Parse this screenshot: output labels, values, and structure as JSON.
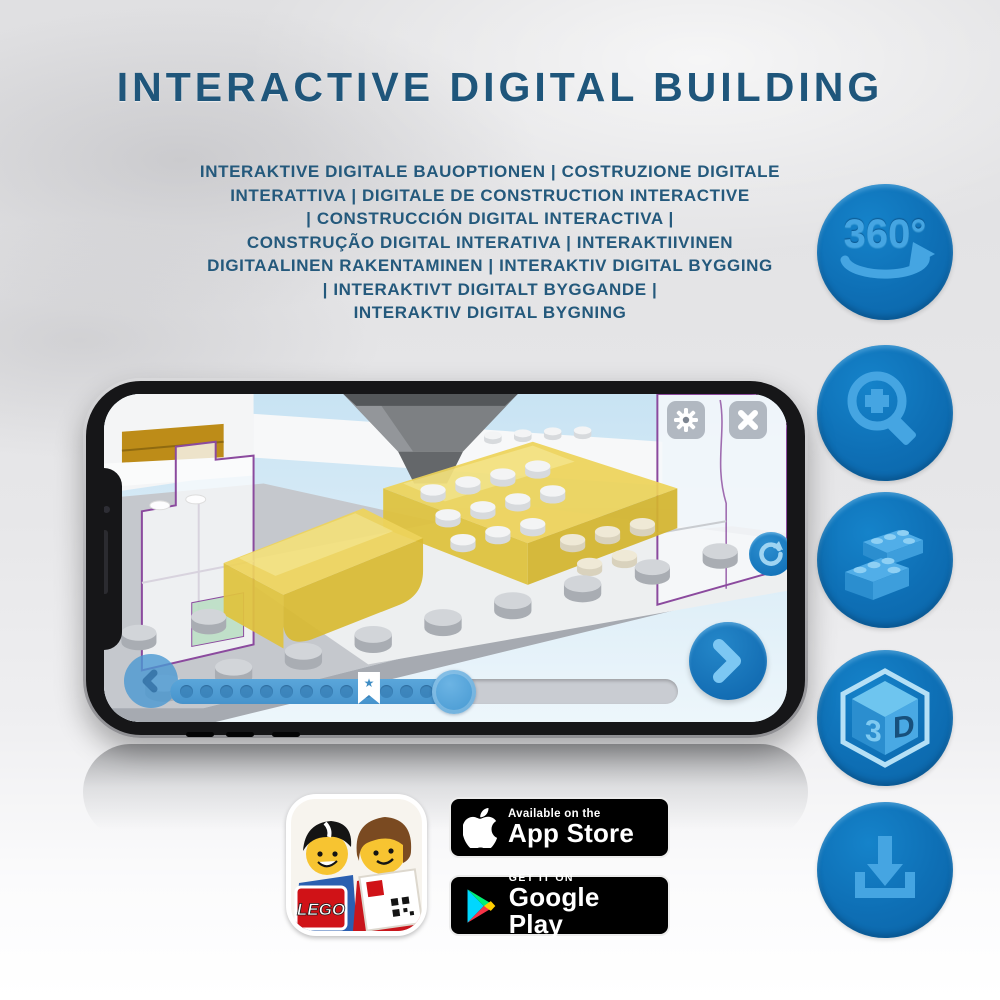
{
  "header": {
    "title": "INTERACTIVE DIGITAL BUILDING",
    "subtitle_lines": [
      "INTERAKTIVE DIGITALE BAUOPTIONEN | COSTRUZIONE DIGITALE",
      "INTERATTIVA | DIGITALE DE CONSTRUCTION INTERACTIVE",
      "| CONSTRUCCIÓN DIGITAL INTERACTIVA |",
      "CONSTRUÇÃO DIGITAL INTERATIVA | INTERAKTIIVINEN",
      "DIGITAALINEN RAKENTAMINEN | INTERAKTIV DIGITAL BYGGING",
      "| INTERAKTIVT DIGITALT BYGGANDE |",
      "INTERAKTIV DIGITAL BYGNING"
    ]
  },
  "feature_icons": [
    {
      "id": "rotate-360-icon",
      "label": "360°"
    },
    {
      "id": "zoom-in-icon"
    },
    {
      "id": "brick-building-icon"
    },
    {
      "id": "view-3d-icon",
      "cube_left": "3",
      "cube_right": "D"
    },
    {
      "id": "download-icon"
    }
  ],
  "phone": {
    "app": {
      "buttons": {
        "settings": "gear-icon",
        "close": "close-icon",
        "rotate_view": "rotate-icon",
        "previous_step": "chevron-left-icon",
        "next_step": "chevron-right-icon"
      },
      "progress": {
        "percent": 56,
        "bookmark_percent": 37,
        "bookmark_glyph": "★"
      }
    }
  },
  "badges": {
    "app_store": {
      "tagline": "Available on the",
      "name": "App Store"
    },
    "google_play": {
      "tagline": "GET IT ON",
      "name": "Google Play"
    }
  },
  "app_icon": {
    "logo_text": "LEGO"
  },
  "colors": {
    "title_blue": "#1f567b",
    "circle_blue": "#0e6fb5",
    "glyph_blue": "#45a5e2",
    "progress_blue": "#4f9fd6",
    "bed_yellow": "#edd35a",
    "outline_purple": "#8b4a9e",
    "badge_black": "#000000"
  }
}
